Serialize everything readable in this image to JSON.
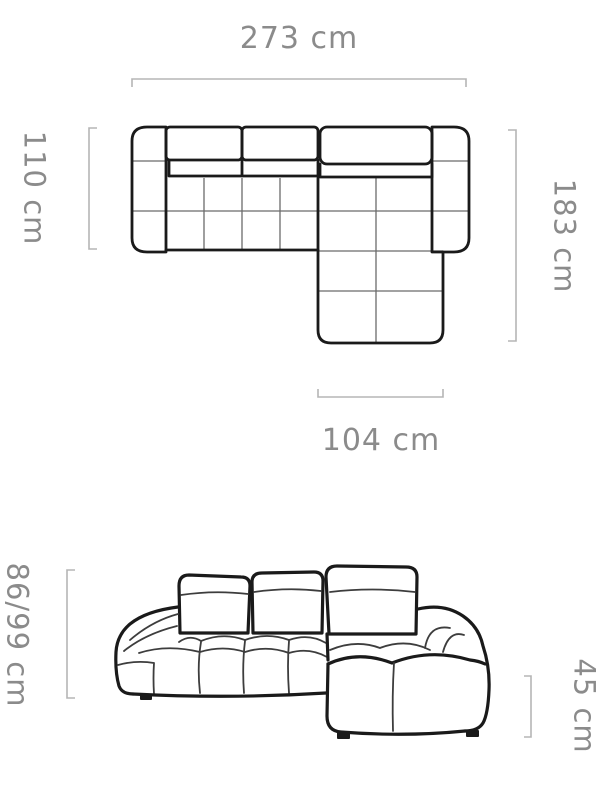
{
  "colors": {
    "bg": "#ffffff",
    "outline": "#1a1a1a",
    "seam": "#6b6b6b",
    "detail": "#3d3d3d",
    "dimension": "#b5b5b5",
    "label": "#8b8b8b"
  },
  "top_view": {
    "width_label": "273 cm",
    "depth_label": "110 cm",
    "total_depth_label": "183 cm",
    "chaise_width_label": "104 cm"
  },
  "front_view": {
    "height_label": "86/99 cm",
    "seat_height_label": "45 cm"
  }
}
